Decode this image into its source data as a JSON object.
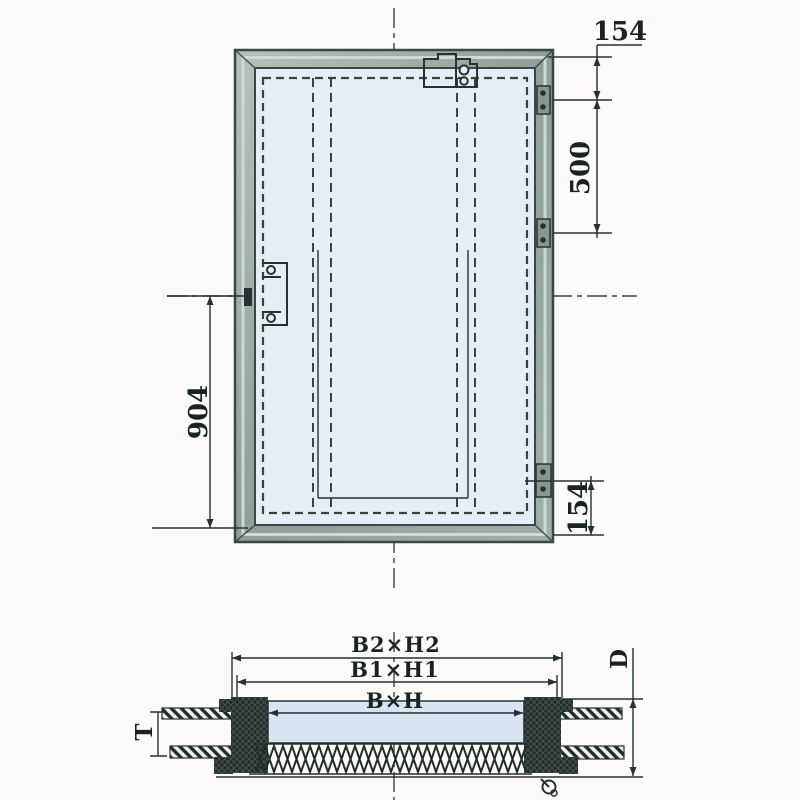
{
  "front_view": {
    "dim_top_right": "154",
    "dim_right": "500",
    "dim_left": "904",
    "dim_bottom_right": "154"
  },
  "section_view": {
    "dim_outer": "B2×H2",
    "dim_middle": "B1×H1",
    "dim_inner": "B×H",
    "dim_depth": "D",
    "dim_plate_thickness": "T"
  },
  "colors": {
    "line": "#273230",
    "frame_fill": "#8da09a",
    "frame_highlight": "#cdd9d3",
    "opening_fill": "#e4eef5",
    "leaf_section_fill": "#d6e5f1",
    "hatch_dark": "#222b28",
    "background": "#fcfbf9"
  }
}
